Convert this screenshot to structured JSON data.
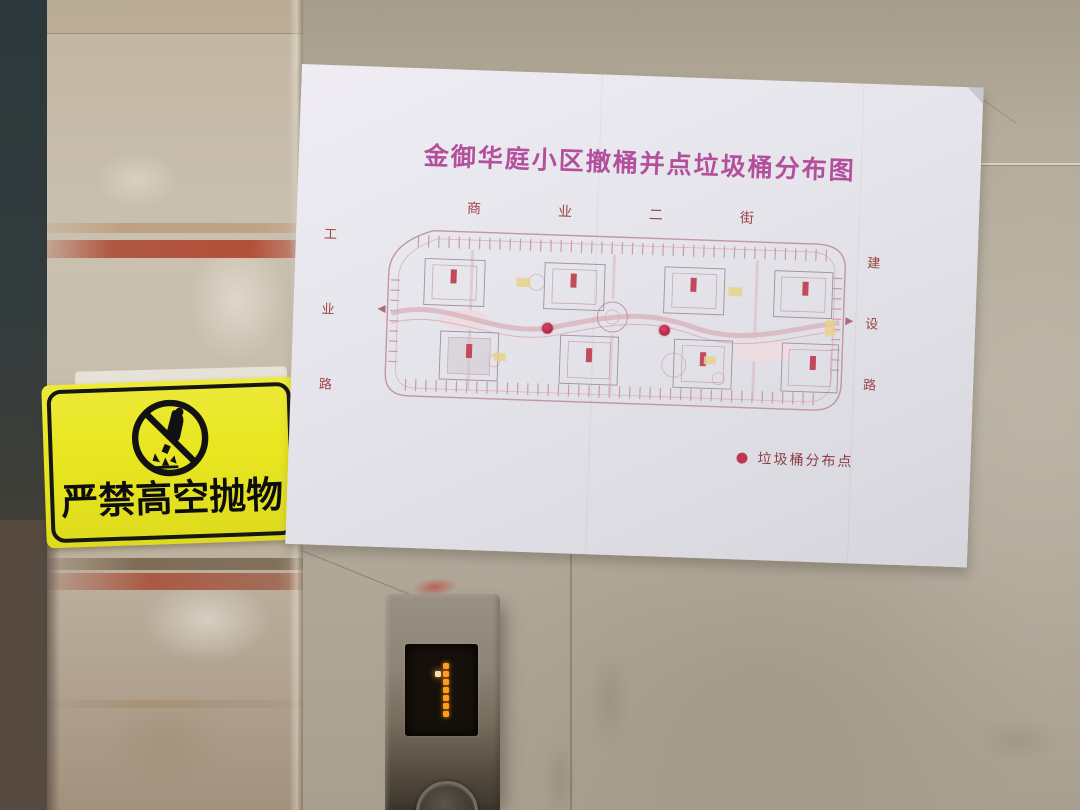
{
  "photo": {
    "description": "Elevator lobby wall: paper poster with community trash-bin distribution site plan, yellow no-throwing warning sign on a marble pillar, elevator call panel showing floor 1"
  },
  "poster": {
    "title": "金御华庭小区撤桶并点垃圾桶分布图",
    "title_color": "#b44f9d",
    "map": {
      "street_top_label": "商业二街",
      "road_left_label": "工业路",
      "road_right_label": "建设路",
      "plan_line_color": "#c495a2",
      "marker_color": "#c23552",
      "markers": [
        {
          "label": "trash-bin-point",
          "style": "left:167px;top:100px"
        },
        {
          "label": "trash-bin-point",
          "style": "left:284px;top:98px"
        }
      ]
    },
    "legend": {
      "dot_color": "#c2354f",
      "label": "垃圾桶分布点"
    }
  },
  "warning_sign": {
    "text": "严禁高空抛物",
    "bg_color": "#e9e621",
    "icon": "no-throwing-objects-icon"
  },
  "elevator": {
    "floor": "1",
    "led_color": "#ff9d20",
    "dot_matrix": [
      "01",
      "21",
      "01",
      "01",
      "01",
      "01",
      "01"
    ]
  },
  "colors": {
    "wall": "#b3aa9b",
    "pillar": "#c6bcab",
    "panel_metal": "#8d8476"
  }
}
